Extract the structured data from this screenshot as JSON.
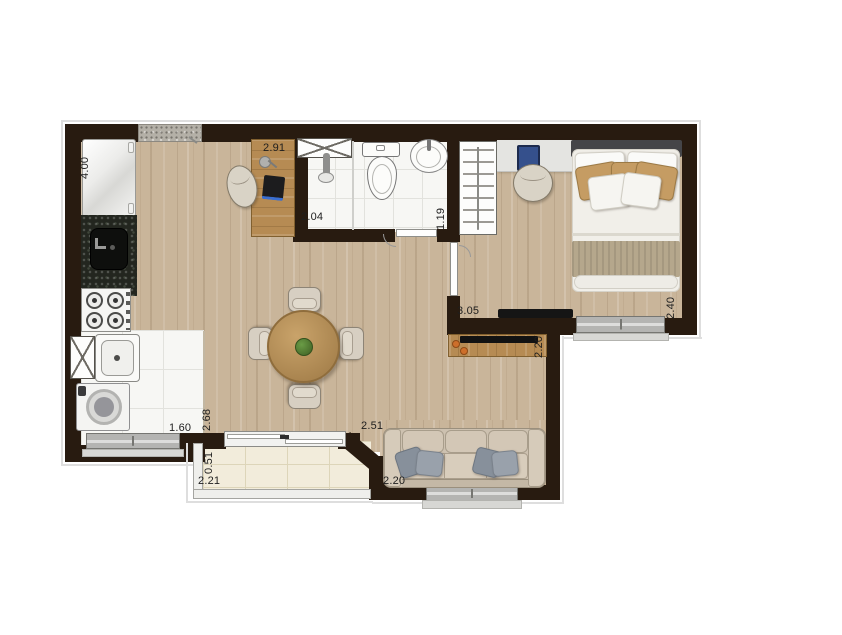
{
  "plan": {
    "type": "apartment-floor-plan",
    "rooms": [
      "kitchen",
      "living-dining",
      "bathroom",
      "bedroom",
      "laundry",
      "balcony"
    ],
    "labels": [
      {
        "id": "kitchen-width",
        "text": "4.00",
        "orientation": "vertical"
      },
      {
        "id": "office-width",
        "text": "2.91",
        "orientation": "horizontal"
      },
      {
        "id": "bathroom-width",
        "text": "2.04",
        "orientation": "horizontal"
      },
      {
        "id": "bathroom-depth",
        "text": "1.19",
        "orientation": "vertical"
      },
      {
        "id": "bedroom-width",
        "text": "3.05",
        "orientation": "horizontal"
      },
      {
        "id": "bedroom-depth",
        "text": "2.40",
        "orientation": "vertical"
      },
      {
        "id": "tv-wall-depth",
        "text": "2.20",
        "orientation": "vertical"
      },
      {
        "id": "living-depth",
        "text": "2.68",
        "orientation": "vertical"
      },
      {
        "id": "laundry-width",
        "text": "1.60",
        "orientation": "horizontal"
      },
      {
        "id": "living-width",
        "text": "2.51",
        "orientation": "horizontal"
      },
      {
        "id": "balcony-depth",
        "text": "0.51",
        "orientation": "vertical"
      },
      {
        "id": "balcony-width",
        "text": "2.21",
        "orientation": "horizontal"
      },
      {
        "id": "sofa-wall-width",
        "text": "2.20",
        "orientation": "horizontal"
      }
    ],
    "furniture": [
      "refrigerator",
      "kitchen-sink-counter",
      "cooktop",
      "laundry-tank",
      "washing-machine",
      "service-shaft",
      "bathroom-shaft",
      "shower",
      "toilet",
      "washbasin",
      "wardrobe",
      "bedroom-desk",
      "laptop",
      "desk-chair",
      "double-bed",
      "bedroom-tv",
      "home-office-desk",
      "desk-lamp",
      "office-chair",
      "round-dining-table",
      "dining-chairs",
      "plant-centerpiece",
      "tv-console",
      "tv",
      "decor-vases",
      "sofa",
      "sofa-pillows",
      "sliding-door",
      "entry-threshold"
    ],
    "colors": {
      "wall": "#281b10",
      "woodFloor": "#c9b59a",
      "tile": "#f7f7f4",
      "balconyTile": "#f2ecdb",
      "furnitureWood": "#b68b53",
      "counterGranite": "#23261f",
      "sofaBeige": "#cdc1b0",
      "pillowGray": "#8e969f",
      "bedTan": "#c59c63",
      "window": "#b4b4b2",
      "tvBlack": "#141414",
      "decoOrange": "#cd6f2b"
    }
  }
}
